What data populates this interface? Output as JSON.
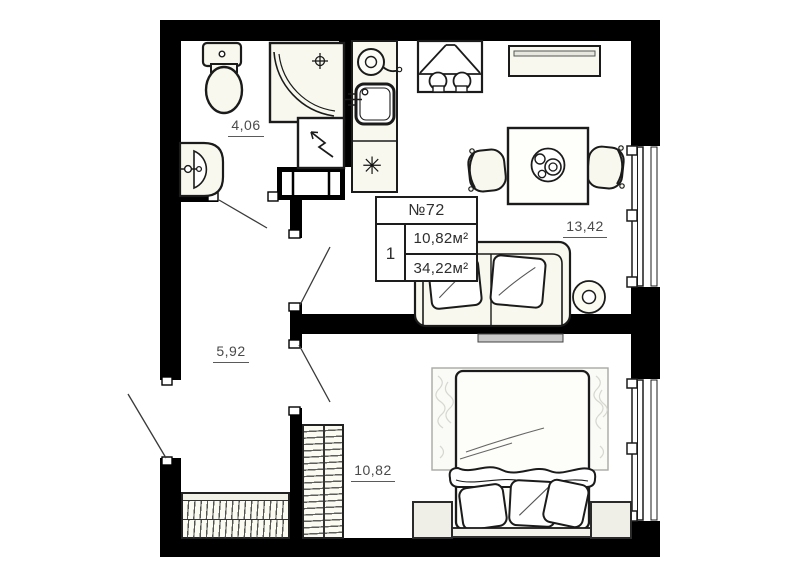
{
  "floor_plan": {
    "info_box": {
      "unit_number": "№72",
      "room_count": "1",
      "living_area": "10,82м²",
      "total_area": "34,22м²"
    },
    "room_areas": {
      "bathroom": "4,06",
      "hallway": "5,92",
      "kitchen_living_room": "13,42",
      "bedroom": "10,82"
    },
    "symbols": {
      "refrigerator_snowflake": "✳"
    },
    "colors": {
      "wall": "#000000",
      "outline": "#1b1b1b",
      "furniture_fill": "#f8f8ee",
      "label": "#4a4a4a"
    }
  }
}
